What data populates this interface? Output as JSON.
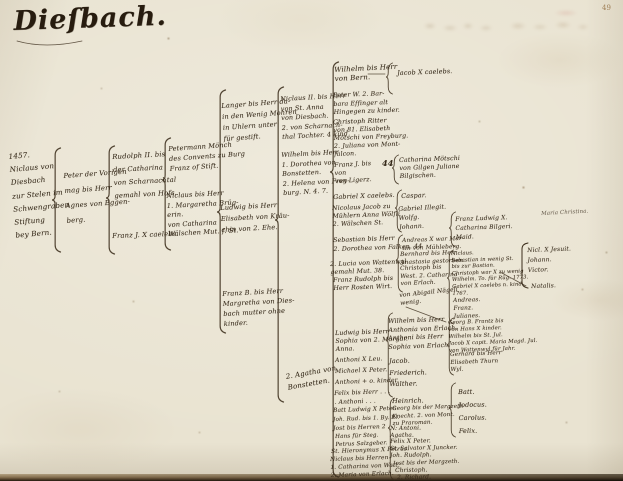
{
  "page": {
    "title": "Dieſbach.",
    "folio": "49"
  },
  "tree": {
    "g1": "1457.\nNiclaus von\nDiesbach\nzur Stelen im\nSchwengraben\nStiftung\nbey Bern.",
    "g2": "Peter der Vorigen\nmag bis Herr\nAgnes von Eggen-\nberg.",
    "g3a": "Rudolph II. bis\nder Catharina\nvon Scharnachtal\ngemahl von Hofs.",
    "g3b": "Franz J. X caelebs.",
    "g4a": "Petermann Mönch\ndes Convents zu Burg\nFranz of Stift.",
    "g4b": "Niclaus bis Herr\n1. Margaretha Brüg-\nerin.\nvon Catharina\nWälschen Mut. f. St.",
    "g5a": "Langer bis Herr da-\nin den Wenig Mohren\nin Uhlern unter\nfür gestift.",
    "g5b": "Ludwig bis Herr\nElisabeth von Kräu-\nchin von 2. Ehe.",
    "g5c": "Franz B. bis Herr\nMargretha von Dies-\nbach mutter ohne\nkinder.",
    "g5note": "2. Agatha von\nBonstetten.",
    "g6a": "Niclaus II. bis Herr\nvon St. Anna\nvon Diesbach.\n2. von Scharnach-\nthal Tochter. 4 kind.",
    "g6b": "Wilhelm bis Herr\n1. Dorothea von\nBonstetten.\n2. Helena von Frey-\nburg. N. 4. 7.",
    "g7a": "Wilhelm bis Herr\nvon Bern.",
    "g7a_child": "Jacob X caelebs.",
    "g7b": "Peter W. 2. Bar-\nbara Effinger alt\nHingegen zu kinder.",
    "g7c": "Christoph Ritter\nvon 81. Elisabeth\nMötschi von Freyburg.\n2. Juliana von Mont-\nfalcon.",
    "g7d": "Franz J. bis\nvon\nvon Ligerz.",
    "g7d_44": "44",
    "g7d_child": "Catharina Mötschi\nvon Gilgen Juliane\nBilgischen.",
    "g7e": "Gabriel X caelebs.",
    "g7f": "Nicolaus Jacob zu\nMühlern Anna Wölfli\n2. Wälschen St.",
    "g7g": "Sebastian bis Herr\n2. Dorothea von Falken. 44",
    "g7h": "2. Lucia von Wattenwyl\ngemahl Mut. 38.",
    "g7i": "Franz Rudolph bis\nHerr Rosten Wirt.",
    "g7j": "Ludwig bis Herr\nSophia von 2. Margar.\nAnna.",
    "g7k": "Anthoni X Leu.",
    "g7l": "Michael X Peter.",
    "g7m": "Anthoni + o. kinder.",
    "g7n": "Felix bis Herr . . .\n. Anthoni . . .",
    "g7o": "Batt Ludwig X Peter.",
    "g7p": "Joh. Rud. bis 1. By. El.",
    "g7q": "Jost bis Herren 2 . . .",
    "g7r": "Hans für Steg.\nPetrus Salzgeber.",
    "g7s": "St. Hieronymus X Petrus.",
    "g7t": "Niclaus bis Herren\n1. Catharina von Watt.\n2. Maria von Erlach.",
    "g8a": "Caspar.",
    "g8b": "Gabriel Illegit.\nWolfg.\nJohann.",
    "g8c": "Andreas X war Mar-\ntin von Mühleberg.",
    "g8d": "Bernhard bis Herr\nAnastasia gestorben.",
    "g8e": "Christoph bis\nWest. 2. Catharina\nvon Erlach.",
    "g8f": "von Abigail Nägeli\nwenig.",
    "g8g": "Wilhelm bis Herr\nAnthonia von Erlach.",
    "g8h": "Anthoni bis Herr\nSophia von Erlach.",
    "g8i": "Jacob.\nFriederich.\nWalther.",
    "g8j": "Heinrich.",
    "g8k": "Georg bis der Margzeth\nKnecht. 2. von Mont.\nzu Praroman.",
    "g8l": "N. Antoni.\nAgatha.",
    "g8m": "Felix X Peter.",
    "g8n": "St. Salvator X Juncker.",
    "g8o": "Joh. Rudolph.",
    "g8p": "Jost bis der Margzeth.",
    "g8q": "Christoph.",
    "g8r": "2. Richard.",
    "g9a": "Franz Ludwig X.\nCatharina Bilgeri.\nMaid.",
    "g9b": "Niclaus.\nSebastian in wenig St.\nbis zur Bastian.\nChristoph war X zu wenig\nWilhelm. To. für Rüg. 1773.\nGabriel X caelebs n. kind.\n1767.",
    "g9c": "Andreas.\nFranz.\nJulianes.",
    "g9d": "Georg B. Frantz bis\nvon Hans X kinder.\nWilhelm bis St. Jul.\nJacob X capit. Maria Magd. Jul.\nvon Wattenwyl für Jahr.",
    "g9e": "Gerhard bis Herr\nElisabeth Thurn\nWyl.",
    "g9f": "Batt.\nJodocus.\nCarolus.\nFelix.",
    "g10a": "Nicl. X Jesuit.\nJohann.\nVictor.",
    "g10b": "Natalis.",
    "g10c": "Maria Christina."
  }
}
